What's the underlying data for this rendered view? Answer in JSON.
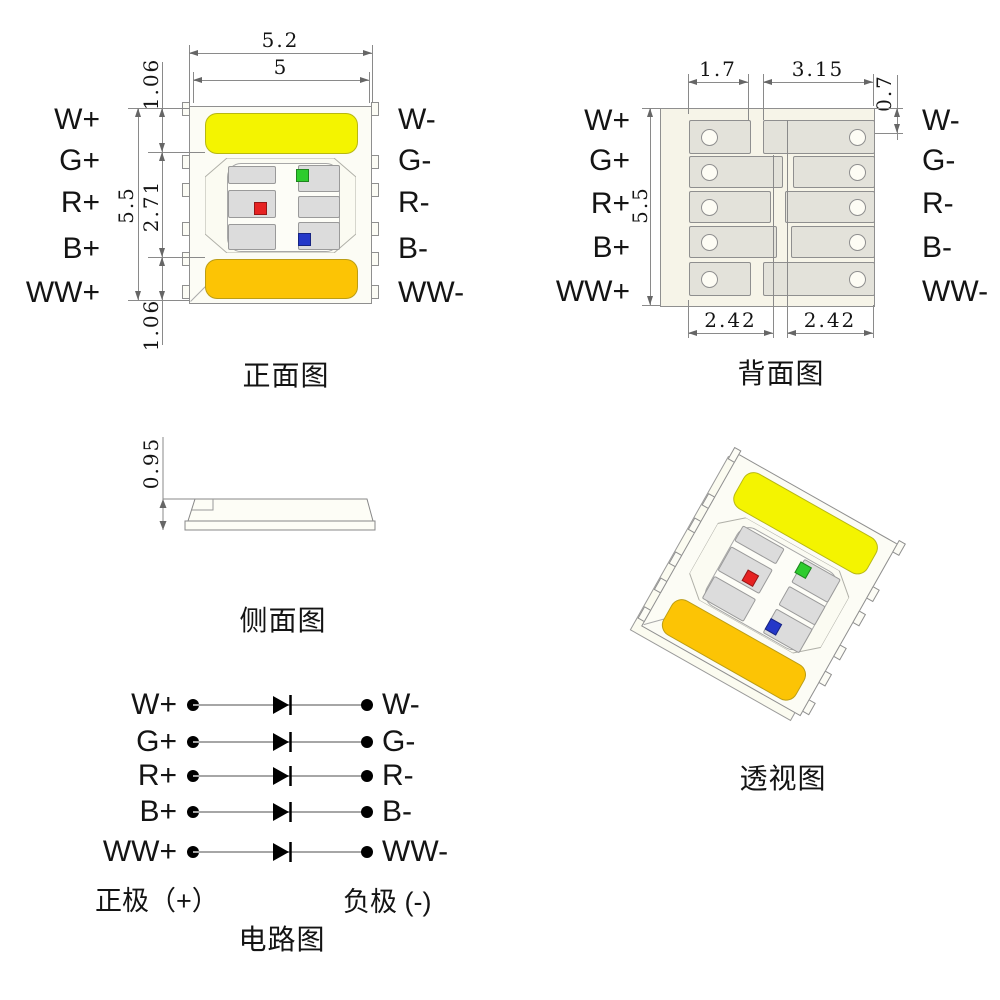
{
  "front_view": {
    "title": "正面图"
  },
  "back_view": {
    "title": "背面图"
  },
  "side_view": {
    "title": "侧面图"
  },
  "perspective_view": {
    "title": "透视图"
  },
  "circuit_view": {
    "title": "电路图",
    "anode_label": "正极（+）",
    "cathode_label": "负极 (-)"
  },
  "channels": [
    {
      "plus": "W+",
      "minus": "W-"
    },
    {
      "plus": "G+",
      "minus": "G-"
    },
    {
      "plus": "R+",
      "minus": "R-"
    },
    {
      "plus": "B+",
      "minus": "B-"
    },
    {
      "plus": "WW+",
      "minus": "WW-"
    }
  ],
  "dimensions": {
    "front": {
      "outer_width": "5.2",
      "emitting_width": "5",
      "top_offset": "1.06",
      "total_height": "5.5",
      "center_height": "2.71",
      "bottom_offset": "1.06"
    },
    "back": {
      "left_pad_width": "1.7",
      "right_pad_width": "3.15",
      "top_offset": "0.7",
      "total_height": "5.5",
      "bottom_left_pitch": "2.42",
      "bottom_right_pitch": "2.42"
    },
    "side": {
      "thickness": "0.95"
    }
  },
  "colors": {
    "white_led": "#f4f400",
    "warm_white_led": "#fcc405",
    "red_chip": "#e62222",
    "green_chip": "#2ecc2e",
    "blue_chip": "#2438c8",
    "front_pad_gray": "#dcdcdc",
    "back_pad_gray": "#e3e2da",
    "package_body": "#fcfcf5",
    "back_body": "#f6f4e8",
    "dim_line": "#8a8a8a"
  }
}
